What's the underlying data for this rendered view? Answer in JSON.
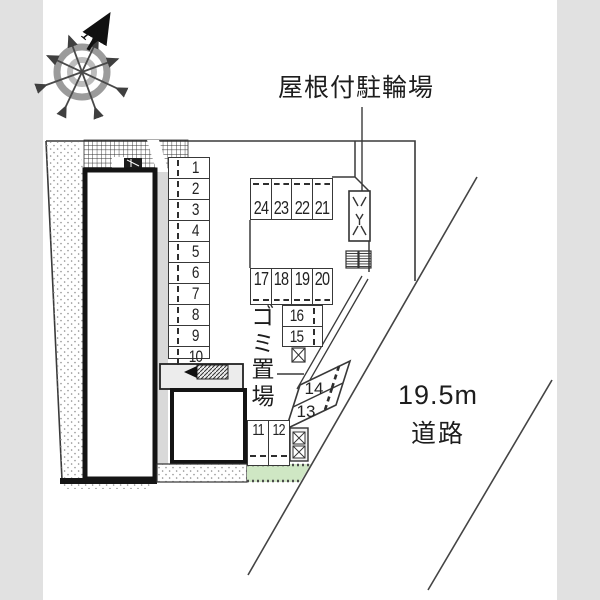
{
  "labels": {
    "bike_parking": "屋根付駐輪場",
    "garbage_area": "ゴミ置場",
    "road_width": "19.5m",
    "road": "道路"
  },
  "compass": {
    "north_label": "N"
  },
  "parking": {
    "column_right": [
      "1",
      "2",
      "3",
      "4",
      "5",
      "6",
      "7",
      "8",
      "9",
      "10"
    ],
    "row_top": [
      "24",
      "23",
      "22",
      "21"
    ],
    "row_middle": [
      "17",
      "18",
      "19",
      "20"
    ],
    "stack": [
      "16",
      "15"
    ],
    "diagonal": [
      "14",
      "13"
    ],
    "bottom_row": [
      "11",
      "12"
    ]
  },
  "icons": {
    "compass": "compass-rose",
    "bike_rack": "bicycle-rack-icon",
    "stairs": "stairs-icon",
    "meter": "meter-icon",
    "coil_boxes": "hatched-box-icon",
    "utility": "utility-box-icon",
    "equipment": "equipment-box-icon"
  },
  "colors": {
    "line": "#3a3a3a",
    "building_wall": "#141414",
    "side_band": "#e1e1e1",
    "walkway_gray": "#d9d9d9",
    "green_area": "#cfe7c4"
  }
}
